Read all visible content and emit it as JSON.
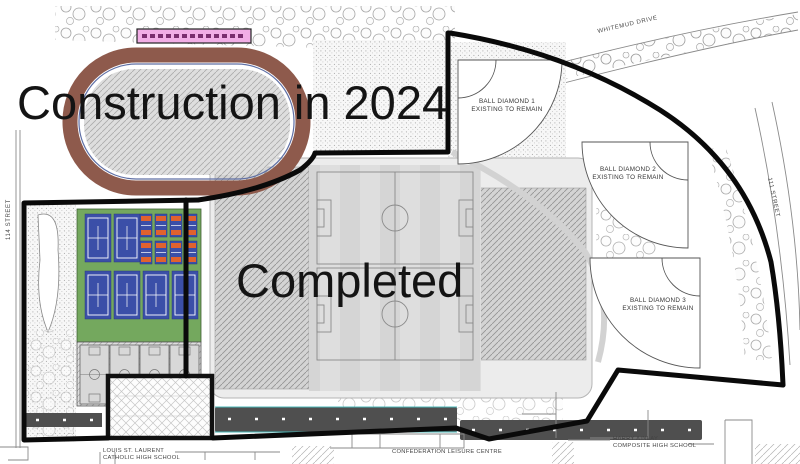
{
  "zones": {
    "construction": "Construction in 2024",
    "completed": "Completed"
  },
  "streets": {
    "whitemud": "WHITEMUD DRIVE",
    "street111": "111 STREET",
    "street114": "114 STREET"
  },
  "ball_diamonds": [
    {
      "name": "BALL DIAMOND 1",
      "status": "EXISTING TO REMAIN"
    },
    {
      "name": "BALL DIAMOND 2",
      "status": "EXISTING TO REMAIN"
    },
    {
      "name": "BALL DIAMOND 3",
      "status": "EXISTING TO REMAIN"
    }
  ],
  "buildings": {
    "louis_line1": "LOUIS ST. LAURENT",
    "louis_line2": "CATHOLIC HIGH SCHOOL",
    "leisure": "CONFEDERATION LEISURE CENTRE",
    "harry_line1": "HARRY AINLAY",
    "harry_line2": "COMPOSITE HIGH SCHOOL"
  },
  "colors": {
    "track_brown": "#8e5a4c",
    "court_green": "#74a85e",
    "court_blue": "#3b4fa8",
    "pickleball_orange": "#e0622e",
    "building_pink": "#f2aee6",
    "road_dark": "#4f4f4f",
    "boundary_black": "#0a0a0a",
    "accent_teal": "#49b8b8"
  }
}
